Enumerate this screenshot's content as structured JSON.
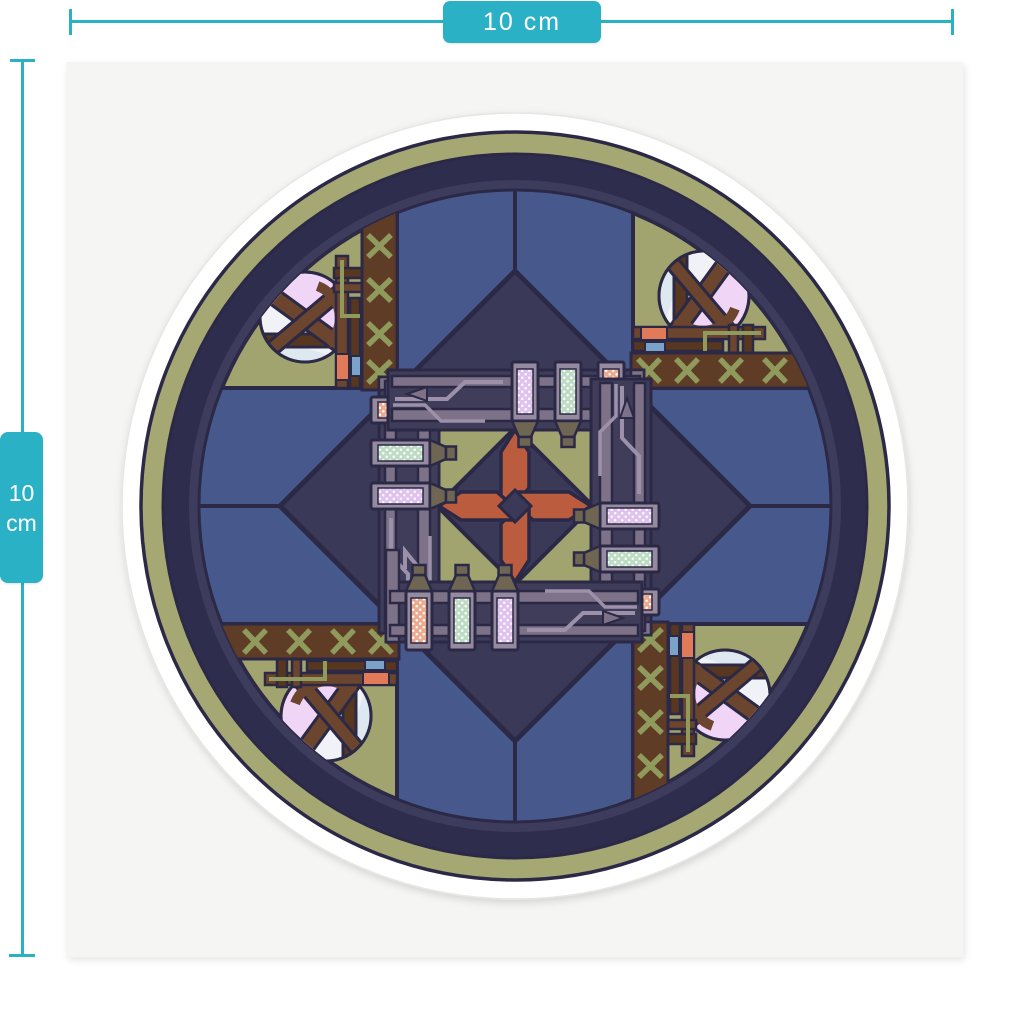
{
  "mockup": {
    "width_dimension": {
      "label": "10 cm"
    },
    "height_dimension": {
      "line1": "10",
      "line2": "cm"
    }
  },
  "palette": {
    "teal": "#2bb1c6",
    "backing": "#f5f5f3",
    "outline": "#2b2946",
    "die-cut-white": "#ffffff",
    "olive-ring": "#a5a872",
    "ring-navy": "#2f2d4e",
    "ring-navy-inner": "#3d3c5d",
    "wedge-blue": "#47598c",
    "diamond-navy": "#3a3958",
    "corner-olive": "#a1a46e",
    "leather": "#5e3c26",
    "stitch": "#8f9a5c",
    "strap": "#6b452e",
    "strap-dark": "#583720",
    "ball-pink": "#f0d5f7",
    "ball-white": "#f0f2f8",
    "ball-blue": "#dde8f0",
    "chip-salmon": "#e07a58",
    "chip-blue": "#7ba3c9",
    "rail": "#7d7287",
    "frame-dark": "#3f3d5a",
    "trace": "#9c90aa",
    "crayon-frame": "#958aa0",
    "tip": "#6f6553",
    "rust": "#bb5c3e",
    "dot-peach": "#ecab8f",
    "dot-mint": "#bedcc4",
    "dot-lavender": "#dfc3ee"
  }
}
